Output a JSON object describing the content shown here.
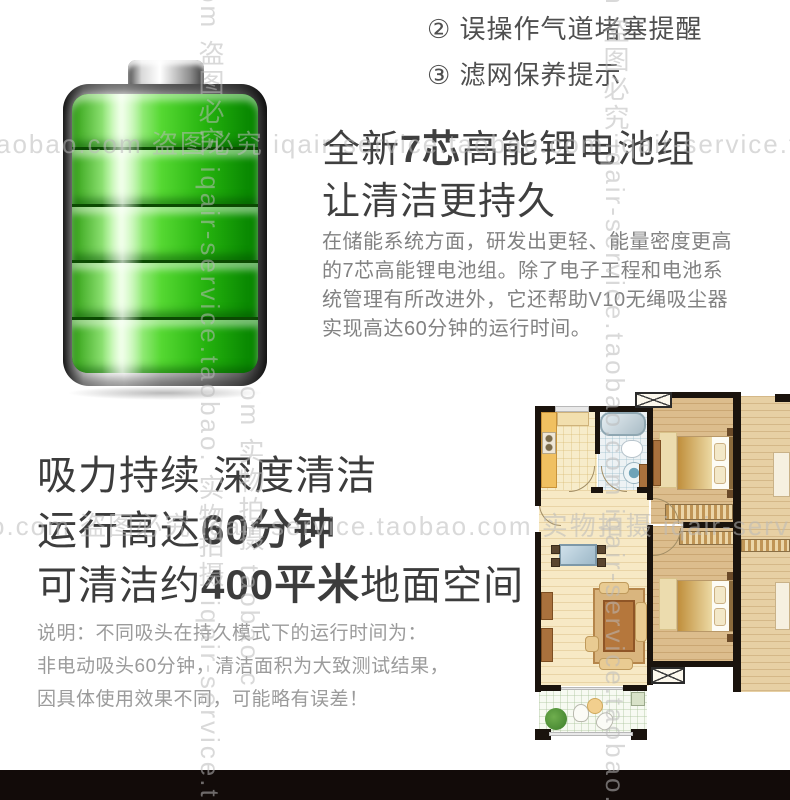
{
  "watermarks": {
    "row1": "aobao.com 盗图必究 iqair-service.taobao.com iqair-service.taobao.com",
    "row2": "o.com 盗图必究 iqair-service.taobao.com 实物拍摄 iqair-service.taobao.com",
    "col1": "om 盗图必究 iqair-service.taobao. 实物拍摄 iqair-service.taob",
    "col2": "m 盗图必究 iqair-service.taobao.com iqair-service.taobao.com",
    "col3": "om 实物拍摄 taobao.c"
  },
  "notice_list": {
    "items": [
      {
        "label": "② 误操作气道堵塞提醒"
      },
      {
        "label": "③ 滤网保养提示"
      }
    ]
  },
  "battery_section": {
    "title_prefix": "全新",
    "title_bold": "7芯",
    "title_suffix": "高能锂电池组",
    "title_line2": "让清洁更持久",
    "body": "在储能系统方面，研发出更轻、能量密度更高的7芯高能锂电池组。除了电子工程和电池系统管理有所改进外，它还帮助V10无绳吸尘器实现高达60分钟的运行时间。"
  },
  "endurance_section": {
    "line1": "吸力持续 深度清洁",
    "line2_prefix": "运行高达",
    "line2_bold": "60分钟",
    "line3_prefix": "可清洁约",
    "line3_bold": "400平米",
    "line3_suffix": "地面空间",
    "note_line1": "说明：不同吸头在持久模式下的运行时间为：",
    "note_line2": "非电动吸头60分钟，清洁面积为大致测试结果，",
    "note_line3": "因具体使用效果不同，可能略有误差！"
  },
  "colors": {
    "battery_green": "#3fc41f",
    "wall_black": "#1a130d",
    "bottom_bar": "#120b09",
    "watermark_gray": "#c9c9c9"
  }
}
